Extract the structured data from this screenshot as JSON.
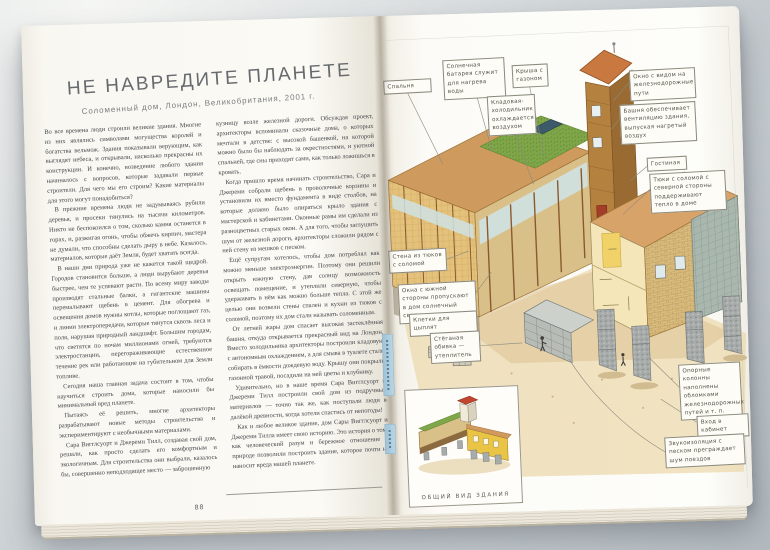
{
  "book": {
    "left_page": {
      "title": "НЕ НАВРЕДИТЕ ПЛАНЕТЕ",
      "subtitle": "Соломенный дом, Лондон, Великобритания, 2001 г.",
      "page_number": "88",
      "column1": "Во все времена люди строили великие здания. Многие из них являлись символами могущества королей и богатства вельмож. Здания показывали верующим, как выглядят небеса, и открывали, насколько прекрасны их конструкции. И конечно, возведение любого здания начиналось с вопросов, которые задавали первые строители. Для чего мы его строим? Какие материалы для этого могут понадобиться?\n В прежние времена люди не задумываясь рубили деревья, и просеки тянулись на тысячи километров. Никто не беспокоился о том, сколько камня останется в горах, и, разжигая огонь, чтобы обжечь кирпич, мастера не думали, что способны сделать дыру в небе. Казалось, материалов, которые даёт Земля, будет хватать всегда.\n В наши дни природа уже не кажется такой щедрой. Городов становится больше, а люди вырубают деревья быстрее, чем те успевают расти. По всему миру заводы производят стальные балки, а гигантские машины перемалывают щебень в цемент. Для обогрева и освещения домов нужны котлы, которые поглощают газ, и линии электропередачи, которые тянутся сквозь леса и поля, нарушая природный ландшафт. Большим городам, что светятся по ночам миллионами огней, требуются электростанции, перегораживающие естественное течение рек или работающие на губительном для Земли топливе.\n Сегодня наша главная задача состоит в том, чтобы научиться строить дома, которые наносили бы минимальный вред планете.\n Пытаясь её решить, многие архитекторы разрабатывают новые методы строительства и экспериментируют с необычными материалами.\n Сара Вигглсуорт и Джереми Тилл, создавая свой дом, решали, как просто сделать его комфортным и экологичным. Для строительства они выбрали, казалось бы, совершенно неподходящее место — заброшенную",
      "column2": "кузницу возле железной дороги. Обсуждая проект, архитекторы вспоминали сказочные дома, о которых мечтали в детстве: с высокой башенкой, на которой можно было бы наблюдать за окрестностями, и уютной спальней, где сны приходят сами, как только ложишься в кровать.\n Когда пришло время начинать строительство, Сара и Джереми собрали щебень в проволочные корзины и установили их вместо фундамента в виде столбов, на которые должно было опираться крыло здания с мастерской и кабинетами. Оконные рамы им сделали из разноцветных старых окон. А для того, чтобы заглушить шум от железной дороги, архитекторы сложили рядом с ней стену из мешков с песком.\n Ещё супругам хотелось, чтобы дом потреблял как можно меньше электроэнергии. Поэтому они решили открыть южную стену, дав солнцу возможность освещать помещение, и утеплили северную, чтобы удерживать в нём как можно больше тепла. С этой же целью они возвели стены спален и кухни из тюков с соломой, поэтому их дом стали называть соломенным.\n От летней жары дом спасает высокая застеклённая башня, откуда открывается прекрасный вид на Лондон. Вместо холодильника архитекторы построили кладовую с автономным охлаждением, а для смыва в туалете стали собирать в ёмкости дождевую воду. Крышу они покрыли газонной травой, посадили на ней цветы и клубнику.\n Удивительно, но в наше время Сара Вигглсуорт и Джереми Тилл построили свой дом из подручных материалов — точно так же, как поступали люди в далёкой древности, когда хотели спастись от непогоды!\n Как и любое великое здание, дом Сары Вигглсуорт и Джереми Тилла имеет свою историю. Это история о том, как человеческий разум и бережное отношение к природе позволили построить здание, которое почти не наносит вреда нашей планете."
    },
    "right_page": {
      "callouts": [
        {
          "text": "Спальня"
        },
        {
          "text": "Солнечная батарея служит для нагрева воды"
        },
        {
          "text": "Крыша с газоном"
        },
        {
          "text": "Кладовая-холодильник охлаждается воздухом"
        },
        {
          "text": "Окно с видом на железнодорожные пути"
        },
        {
          "text": "Башня обеспечивает вентиляцию здания, выпуская нагретый воздух"
        },
        {
          "text": "Гостиная"
        },
        {
          "text": "Тюки с соломой с северной стороны поддерживают тепло в доме"
        },
        {
          "text": "Стена из тюков с соломой"
        },
        {
          "text": "Окна с южной стороны пропускают в дом солнечный свет"
        },
        {
          "text": "Клетки для цыплят"
        },
        {
          "text": "Стёганая обивка — утеплитель"
        },
        {
          "text": "Опорные колонны наполнены обломками железнодорожных путей и т. п."
        },
        {
          "text": "Вход в кабинет"
        },
        {
          "text": "Звукоизоляция с песком преграждает шум поездов"
        }
      ],
      "inset_caption": "ОБЩИЙ ВИД ЗДАНИЯ"
    }
  },
  "colors": {
    "roof_tan": "#d1995c",
    "grass_green": "#7fa648",
    "straw_yellow": "#e4c27c",
    "gabion_gray": "#a7abaa",
    "tower_wood": "#b5813f",
    "accent_tab_blue": "#a9c9dc"
  }
}
